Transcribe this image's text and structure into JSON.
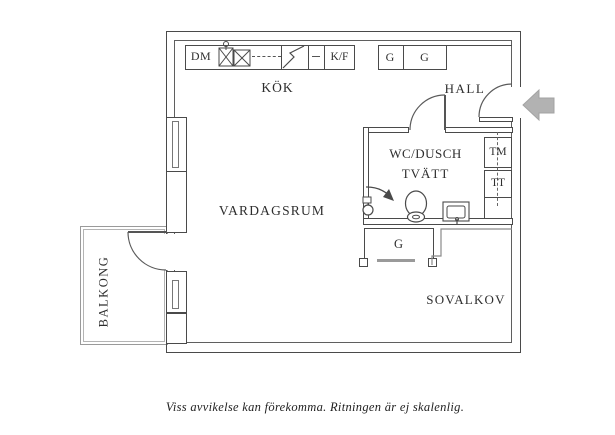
{
  "caption": "Viss avvikelse kan förekomma. Ritningen är ej skalenlig.",
  "rooms": {
    "kok": "KÖK",
    "hall": "HALL",
    "vardagsrum": "VARDAGSRUM",
    "wc_line1": "WC/DUSCH",
    "wc_line2": "TVÄTT",
    "sovalkov": "SOVALKOV",
    "balkong": "BALKONG"
  },
  "fixtures": {
    "dm": "DM",
    "kf": "K/F",
    "g1": "G",
    "g2": "G",
    "g_closet": "G",
    "tm": "TM",
    "tt": "TT"
  },
  "icons": {
    "entry_arrow": "left-arrow",
    "toilet": "toilet-symbol",
    "shower": "shower-symbol",
    "bath_sink": "sink-symbol",
    "kitchen_sink": "crossed-box-sink",
    "stove": "stove-diagonal"
  },
  "colors": {
    "wall": "#4a4a4a",
    "line_light": "#999999",
    "arrow": "#b2b2b2",
    "text": "#2e2e2e"
  }
}
